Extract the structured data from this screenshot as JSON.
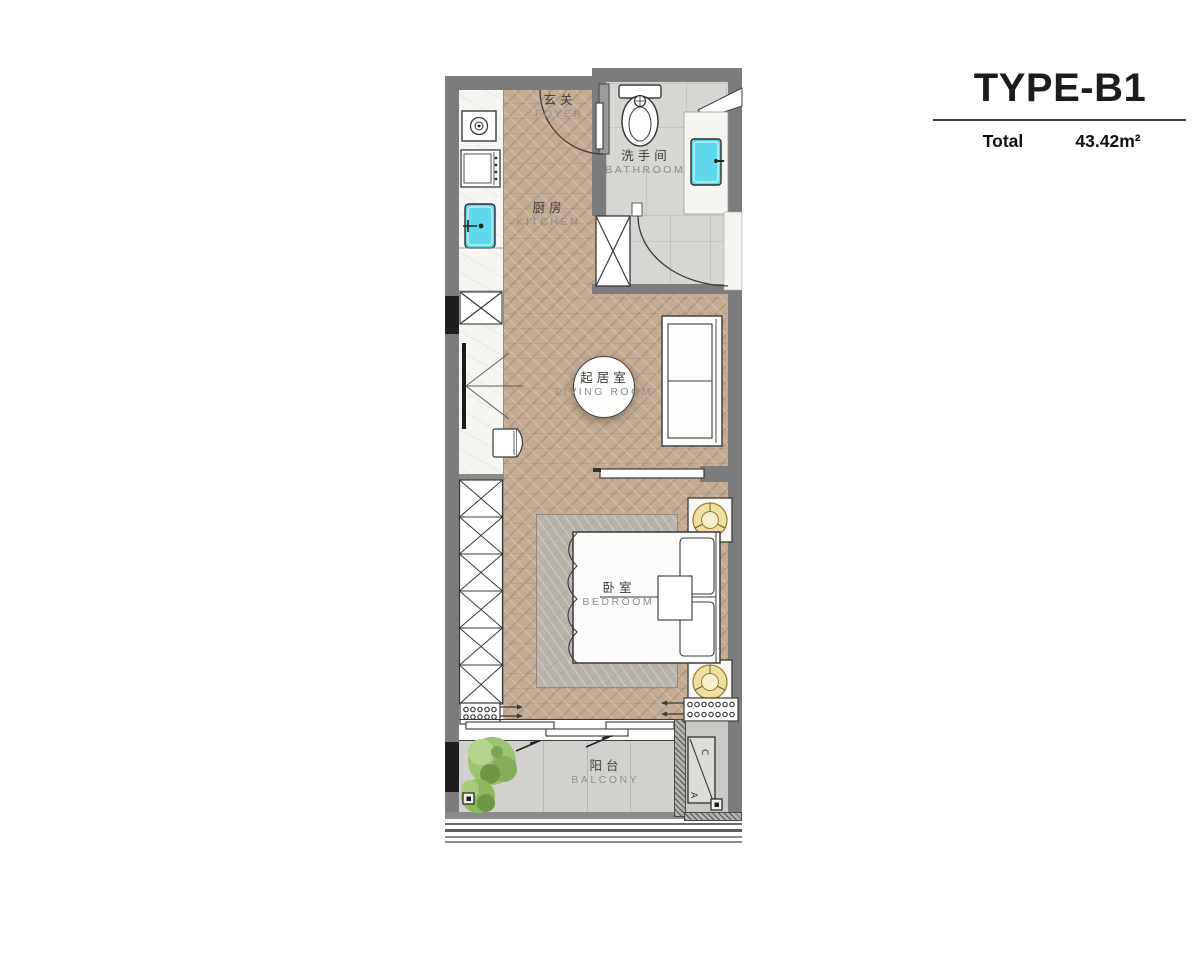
{
  "header": {
    "type_label": "TYPE-B1",
    "total_label": "Total",
    "area_value": "43.42m²"
  },
  "rooms": {
    "foyer": {
      "zh": "玄关",
      "en": "FOYER"
    },
    "kitchen": {
      "zh": "厨房",
      "en": "KITCHEN"
    },
    "bathroom": {
      "zh": "洗手间",
      "en": "BATHROOM"
    },
    "living_room": {
      "zh": "起居室",
      "en": "LIVING ROOM"
    },
    "bedroom": {
      "zh": "卧室",
      "en": "BEDROOM"
    },
    "balcony": {
      "zh": "阳台",
      "en": "BALCONY"
    }
  },
  "annotations": {
    "ac_letter_a": "A",
    "ac_letter_c": "C"
  },
  "colors": {
    "wall_gray": "#7c7c7c",
    "accent_black": "#1e1e1e",
    "wood_floor": "#c4ab92",
    "tile_gray": "#d7d6d2",
    "fixture_cyan": "#5fd8e9",
    "lamp_gold": "#f0dfa0",
    "rug_gray": "#b8b4ab",
    "plant_green": "#8db85e",
    "line_dark": "#3a3a3a"
  }
}
